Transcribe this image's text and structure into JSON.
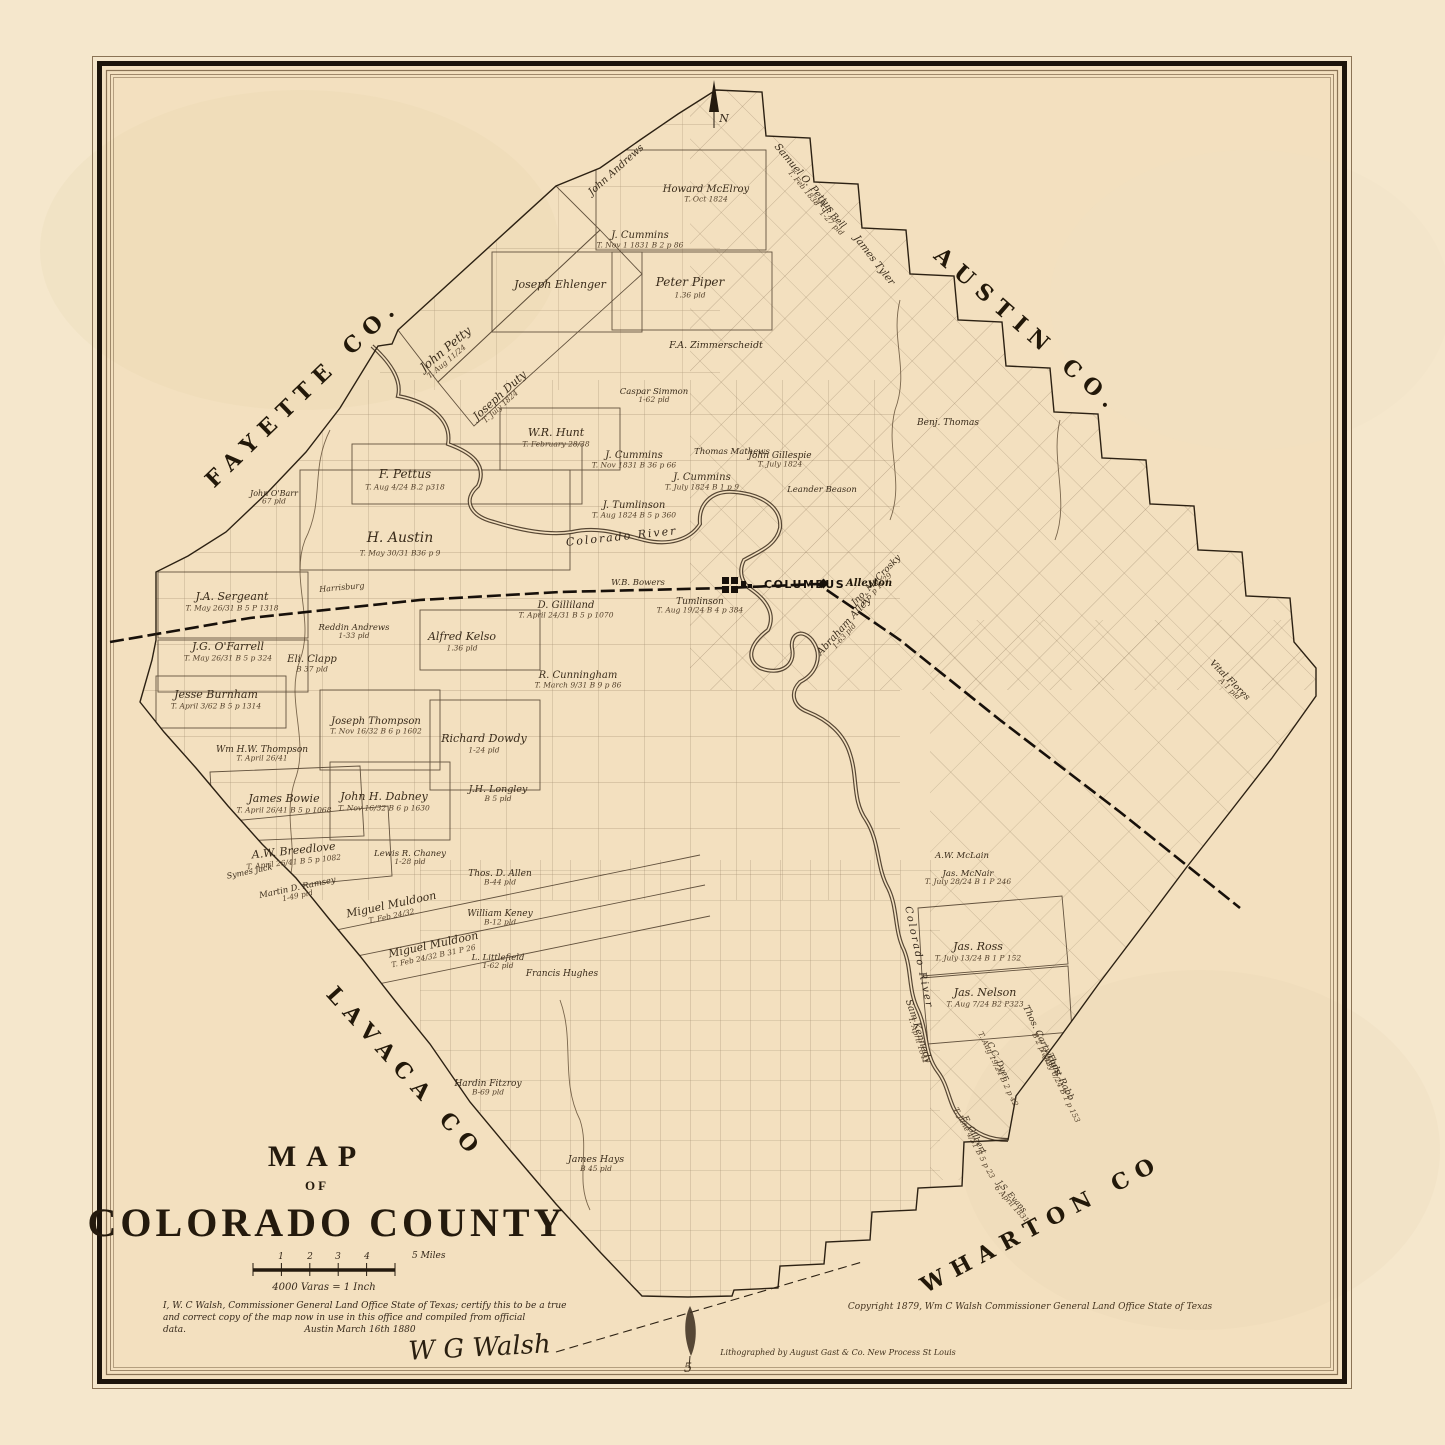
{
  "title": {
    "line1": "MAP",
    "line2": "OF",
    "line3": "COLORADO COUNTY"
  },
  "scale": {
    "ticks": [
      "1",
      "2",
      "3",
      "4"
    ],
    "end_label": "5 Miles",
    "varas": "4000 Varas = 1 Inch"
  },
  "certification": {
    "line1": "I, W. C Walsh, Commissioner General Land Office  State of Texas; certify this to be a true",
    "line2": "and correct copy of the map now in use in this office and compiled from official",
    "line3": "data.",
    "dateline": "Austin  March 16th 1880",
    "signature": "W G Walsh"
  },
  "credits": {
    "copyright": "Copyright 1879, Wm C Walsh  Commissioner  General Land Office   State of Texas",
    "lithographer": "Lithographed by August Gast & Co. New Process St Louis"
  },
  "compass": {
    "label": "N"
  },
  "neighbors": [
    {
      "name": "FAYETTE CO.",
      "x": 308,
      "y": 398,
      "rot": -44
    },
    {
      "name": "AUSTIN CO.",
      "x": 1023,
      "y": 336,
      "rot": 41
    },
    {
      "name": "LAVACA CO",
      "x": 400,
      "y": 1078,
      "rot": 48
    },
    {
      "name": "WHARTON CO",
      "x": 1045,
      "y": 1230,
      "rot": -28
    }
  ],
  "places": [
    {
      "name": "COLUMBUS",
      "x": 764,
      "y": 588,
      "type": "major"
    },
    {
      "name": "Alleyton",
      "x": 846,
      "y": 586,
      "type": "minor"
    }
  ],
  "rivers": [
    {
      "name": "Colorado River",
      "x": 622,
      "y": 540,
      "rot": -6,
      "fs": 11
    },
    {
      "name": "Colorado River",
      "x": 916,
      "y": 958,
      "rot": 78,
      "fs": 10
    }
  ],
  "annotations": [
    {
      "text": "Harrisburg",
      "x": 342,
      "y": 590,
      "rot": -5,
      "fs": 8
    },
    {
      "text": "5",
      "x": 688,
      "y": 1372,
      "rot": 0,
      "fs": 13
    }
  ],
  "parcels": [
    {
      "name": "John Petty",
      "sub": "T. Aug 11/24",
      "x": 448,
      "y": 352,
      "rot": -40,
      "fs": 12
    },
    {
      "name": "Joseph Duty",
      "sub": "T. July 1824",
      "x": 502,
      "y": 398,
      "rot": -42,
      "fs": 11
    },
    {
      "name": "John Andrews",
      "x": 618,
      "y": 172,
      "rot": -42,
      "fs": 10
    },
    {
      "name": "Howard McElroy",
      "sub": "T. Oct 1824",
      "x": 706,
      "y": 192,
      "fs": 10
    },
    {
      "name": "J. Cummins",
      "sub": "T. Nov 1 1831  B 2 p 86",
      "x": 640,
      "y": 238,
      "fs": 10
    },
    {
      "name": "Samuel O. Pettus",
      "sub": "T. Feb 1838",
      "x": 802,
      "y": 180,
      "rot": 50,
      "fs": 10
    },
    {
      "name": "A.J. Bell",
      "sub": "1-27 pld",
      "x": 830,
      "y": 216,
      "rot": 46,
      "fs": 9
    },
    {
      "name": "James Tyler",
      "x": 872,
      "y": 262,
      "rot": 52,
      "fs": 10
    },
    {
      "name": "Joseph Ehlenger",
      "x": 560,
      "y": 288,
      "fs": 11
    },
    {
      "name": "Peter Piper",
      "sub": "1.36 pld",
      "x": 690,
      "y": 286,
      "fs": 12
    },
    {
      "name": "F.A. Zimmerscheidt",
      "x": 716,
      "y": 348,
      "fs": 9.5
    },
    {
      "name": "Caspar Simmon",
      "sub": "1-62 pld",
      "x": 654,
      "y": 394,
      "fs": 8.5
    },
    {
      "name": "Benj. Thomas",
      "x": 948,
      "y": 425,
      "fs": 9
    },
    {
      "name": "W.R. Hunt",
      "sub": "T. February 28/38",
      "x": 556,
      "y": 436,
      "fs": 11
    },
    {
      "name": "J. Cummins",
      "sub": "T. Nov 1831  B 36 p 66",
      "x": 634,
      "y": 458,
      "fs": 10
    },
    {
      "name": "J. Cummins",
      "sub": "T. July 1824  B 1 p 9",
      "x": 702,
      "y": 480,
      "fs": 10
    },
    {
      "name": "Thomas Mathews",
      "x": 732,
      "y": 454,
      "fs": 8.5
    },
    {
      "name": "John Gillespie",
      "sub": "T. July 1824",
      "x": 780,
      "y": 458,
      "fs": 9
    },
    {
      "name": "Leander Beason",
      "x": 822,
      "y": 492,
      "fs": 8.5
    },
    {
      "name": "J. Tumlinson",
      "sub": "T. Aug 1824  B 5 p 360",
      "x": 634,
      "y": 508,
      "fs": 10
    },
    {
      "name": "F. Pettus",
      "sub": "T. Aug 4/24  B.2 p318",
      "x": 405,
      "y": 478,
      "fs": 12
    },
    {
      "name": "H. Austin",
      "sub": "T. May 30/31  B36 p 9",
      "x": 400,
      "y": 542,
      "fs": 14
    },
    {
      "name": "J.A. Sergeant",
      "sub": "T. May 26/31  B 5 P 1318",
      "x": 232,
      "y": 600,
      "fs": 11
    },
    {
      "name": "J.G. O'Farrell",
      "sub": "T. May 26/31  B 5 p 324",
      "x": 228,
      "y": 650,
      "fs": 11
    },
    {
      "name": "John O'Barr",
      "sub": "67 pld",
      "x": 274,
      "y": 496,
      "fs": 8
    },
    {
      "name": "Jesse Burnham",
      "sub": "T. April 3/62  B 5 p 1314",
      "x": 216,
      "y": 698,
      "fs": 11
    },
    {
      "name": "Eli. Clapp",
      "sub": "B 37 pld",
      "x": 312,
      "y": 662,
      "fs": 10
    },
    {
      "name": "Reddin Andrews",
      "sub": "1-33 pld",
      "x": 354,
      "y": 630,
      "fs": 8.5
    },
    {
      "name": "Alfred Kelso",
      "sub": "1.36 pld",
      "x": 462,
      "y": 640,
      "fs": 11
    },
    {
      "name": "D. Gilliland",
      "sub": "T. April 24/31  B 5 p 1070",
      "x": 566,
      "y": 608,
      "fs": 10
    },
    {
      "name": "W.B. Bowers",
      "x": 638,
      "y": 585,
      "fs": 8.5
    },
    {
      "name": "Tumlinson",
      "sub": "T. Aug 19/24  B 4 p 384",
      "x": 700,
      "y": 604,
      "fs": 9
    },
    {
      "name": "Jno. McCrosky",
      "sub": "B 5 p 1029",
      "x": 878,
      "y": 582,
      "rot": -46,
      "fs": 9
    },
    {
      "name": "Abraham Alley",
      "sub": "1-63 pld",
      "x": 846,
      "y": 628,
      "rot": -48,
      "fs": 10
    },
    {
      "name": "R. Cunningham",
      "sub": "T. March 9/31  B 9 p 86",
      "x": 578,
      "y": 678,
      "fs": 10
    },
    {
      "name": "Richard Dowdy",
      "sub": "1-24 pld",
      "x": 484,
      "y": 742,
      "fs": 11
    },
    {
      "name": "Joseph Thompson",
      "sub": "T. Nov 16/32  B 6 p 1602",
      "x": 376,
      "y": 724,
      "fs": 10
    },
    {
      "name": "Wm H.W. Thompson",
      "sub": "T. April 26/41",
      "x": 262,
      "y": 752,
      "fs": 9
    },
    {
      "name": "James Bowie",
      "sub": "T. April 26/41  B 5 p 1068",
      "x": 284,
      "y": 802,
      "fs": 11
    },
    {
      "name": "John H. Dabney",
      "sub": "T. Nov 16/32  B 6 p 1630",
      "x": 384,
      "y": 800,
      "fs": 11
    },
    {
      "name": "J.H. Longley",
      "sub": "B 5 pld",
      "x": 498,
      "y": 792,
      "fs": 9.5
    },
    {
      "name": "Lewis R. Chaney",
      "sub": "1-28 pld",
      "x": 410,
      "y": 856,
      "fs": 8.5
    },
    {
      "name": "A.W. Breedlove",
      "sub": "T. April 26/41  B 5 p 1082",
      "x": 294,
      "y": 854,
      "rot": -6,
      "fs": 11
    },
    {
      "name": "Symes Jack",
      "x": 250,
      "y": 874,
      "rot": -12,
      "fs": 8
    },
    {
      "name": "Martin D. Ramsey",
      "sub": "1-49 pld",
      "x": 298,
      "y": 890,
      "rot": -12,
      "fs": 8.5
    },
    {
      "name": "Miguel Muldoon",
      "sub": "T. Feb 24/32",
      "x": 392,
      "y": 908,
      "rot": -12,
      "fs": 11
    },
    {
      "name": "Miguel Muldoon",
      "sub": "T. Feb 24/32  B 31 P 26",
      "x": 434,
      "y": 948,
      "rot": -12,
      "fs": 11
    },
    {
      "name": "Thos. D. Allen",
      "sub": "B-44 pld",
      "x": 500,
      "y": 876,
      "fs": 9
    },
    {
      "name": "William Keney",
      "sub": "B-12 pld",
      "x": 500,
      "y": 916,
      "fs": 9
    },
    {
      "name": "L. Littlefield",
      "sub": "1-62 pld",
      "x": 498,
      "y": 960,
      "fs": 8.5
    },
    {
      "name": "Francis Hughes",
      "x": 562,
      "y": 976,
      "fs": 9
    },
    {
      "name": "Hardin Fitzroy",
      "sub": "B-69 pld",
      "x": 488,
      "y": 1086,
      "fs": 9
    },
    {
      "name": "James Hays",
      "sub": "B 45 pld",
      "x": 596,
      "y": 1162,
      "fs": 9.5
    },
    {
      "name": "A.W. McLain",
      "x": 962,
      "y": 858,
      "fs": 8.5
    },
    {
      "name": "Jas. McNair",
      "sub": "T. July 28/24  B 1 P 246",
      "x": 968,
      "y": 876,
      "fs": 8.5
    },
    {
      "name": "Jas. Ross",
      "sub": "T. July 13/24  B 1 P 152",
      "x": 978,
      "y": 950,
      "fs": 11
    },
    {
      "name": "Jas. Nelson",
      "sub": "T. Aug 7/24  B2 P323",
      "x": 985,
      "y": 996,
      "fs": 11
    },
    {
      "name": "Sam Kennedy",
      "sub": "T. April 1841",
      "x": 916,
      "y": 1032,
      "rot": 72,
      "fs": 9.5
    },
    {
      "name": "C.C. Dyer",
      "sub": "T. Aug 19/24  B 2 p 42",
      "x": 996,
      "y": 1062,
      "rot": 64,
      "fs": 8.5
    },
    {
      "name": "Thos. Cartwright",
      "sub": "B 2 p 442",
      "x": 1040,
      "y": 1042,
      "rot": 64,
      "fs": 9
    },
    {
      "name": "Thos. Rabb",
      "sub": "T. July 6/24  B 1 p 153",
      "x": 1058,
      "y": 1078,
      "rot": 64,
      "fs": 9
    },
    {
      "name": "E. Gilbert",
      "sub": "T. June 4/31  B 5 p 23",
      "x": 972,
      "y": 1136,
      "rot": 62,
      "fs": 8.5
    },
    {
      "name": "J.S. Evans",
      "sub": "6 April 1831",
      "x": 1010,
      "y": 1198,
      "rot": 48,
      "fs": 8
    },
    {
      "name": "Vital Flores",
      "sub": "A 1 pld",
      "x": 1228,
      "y": 682,
      "rot": 45,
      "fs": 9
    }
  ]
}
